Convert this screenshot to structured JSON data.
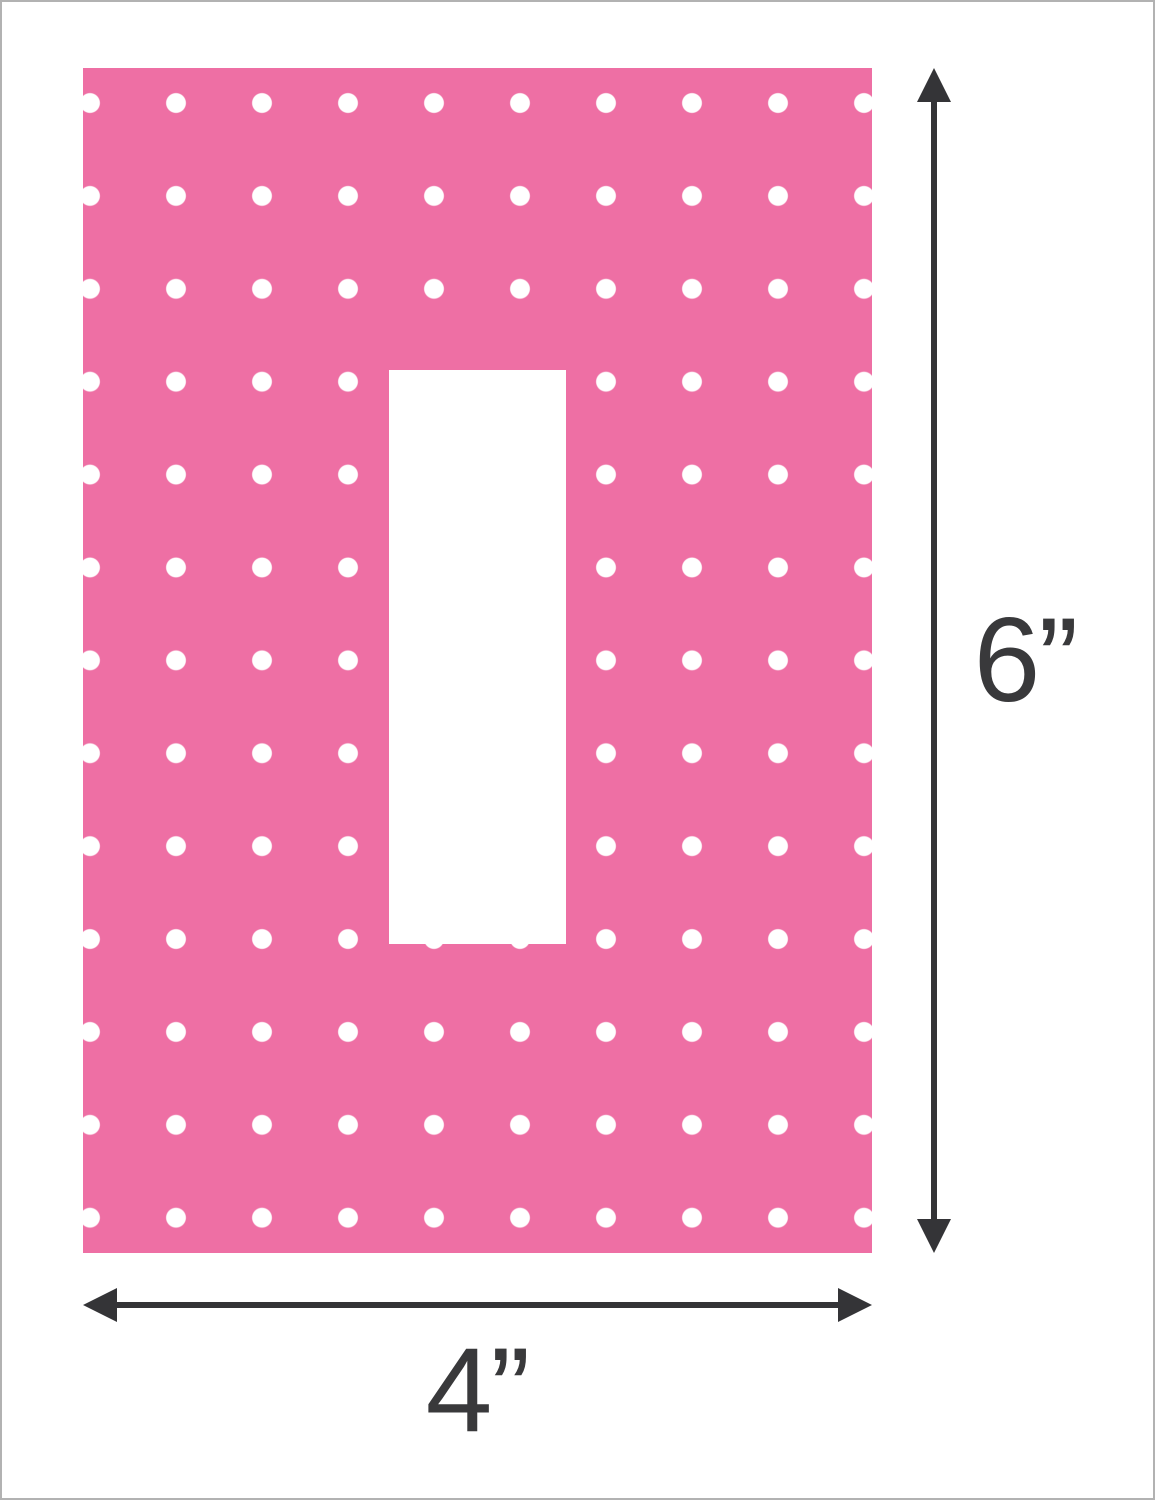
{
  "colors": {
    "plate-pink": "#ee6fa4",
    "dot-white": "#ffffff",
    "arrow-dark": "#343437",
    "label-ink": "#39393b",
    "frame-gray": "#b2b2b2",
    "bg-white": "#ffffff"
  },
  "diagram": {
    "height_label": "6”",
    "width_label": "4”"
  }
}
